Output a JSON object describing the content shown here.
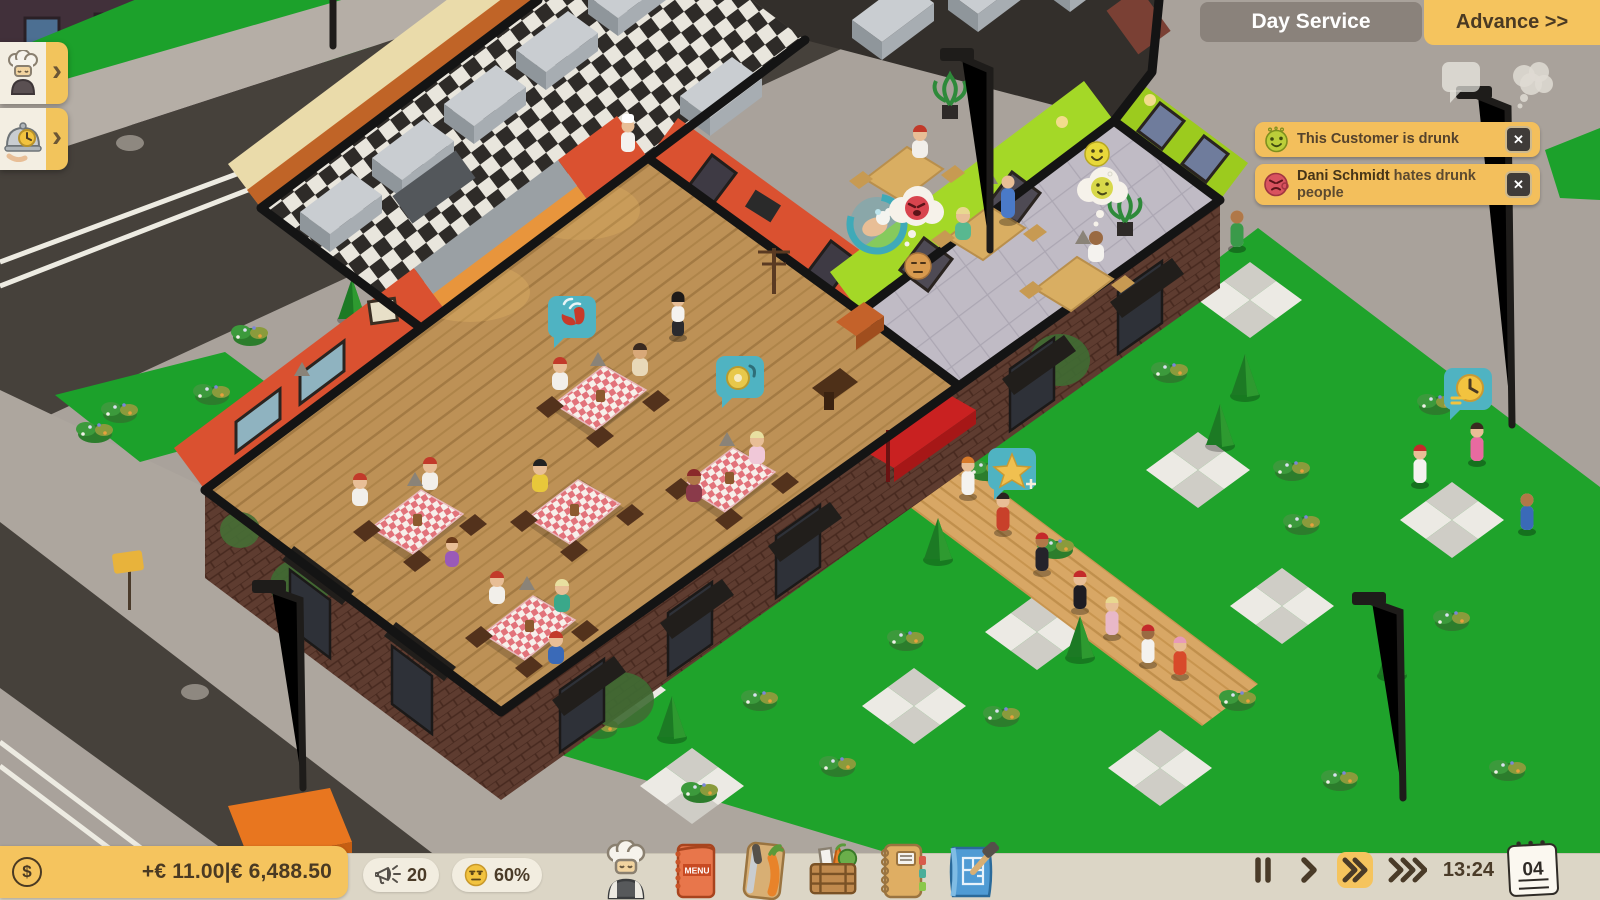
{
  "hud": {
    "phase_label": "Day Service",
    "advance_label": "Advance >>",
    "notifications": [
      {
        "icon": "drunk-face",
        "text": "This Customer is drunk"
      },
      {
        "icon": "angry-face",
        "name": "Dani Schmidt",
        "text": " hates drunk people"
      }
    ]
  },
  "bottom_bar": {
    "money_delta": "+€ 11.00",
    "separator": "|",
    "money_total": "€ 6,488.50",
    "marketing": "20",
    "satisfaction": "60%",
    "menu_label": "MENU",
    "time": "13:24",
    "day": "04"
  },
  "icons": {
    "close": "✕",
    "chevron": "›",
    "currency": "$"
  },
  "colors": {
    "accent_yellow": "#F5C45E",
    "notification_yellow": "#F3BF5C",
    "bar_beige": "#DCD6C6",
    "bubble_teal": "#4FB3C2",
    "wall_red": "#D8502C",
    "wall_green": "#9ED21F",
    "text_brown": "#4A3A23"
  }
}
